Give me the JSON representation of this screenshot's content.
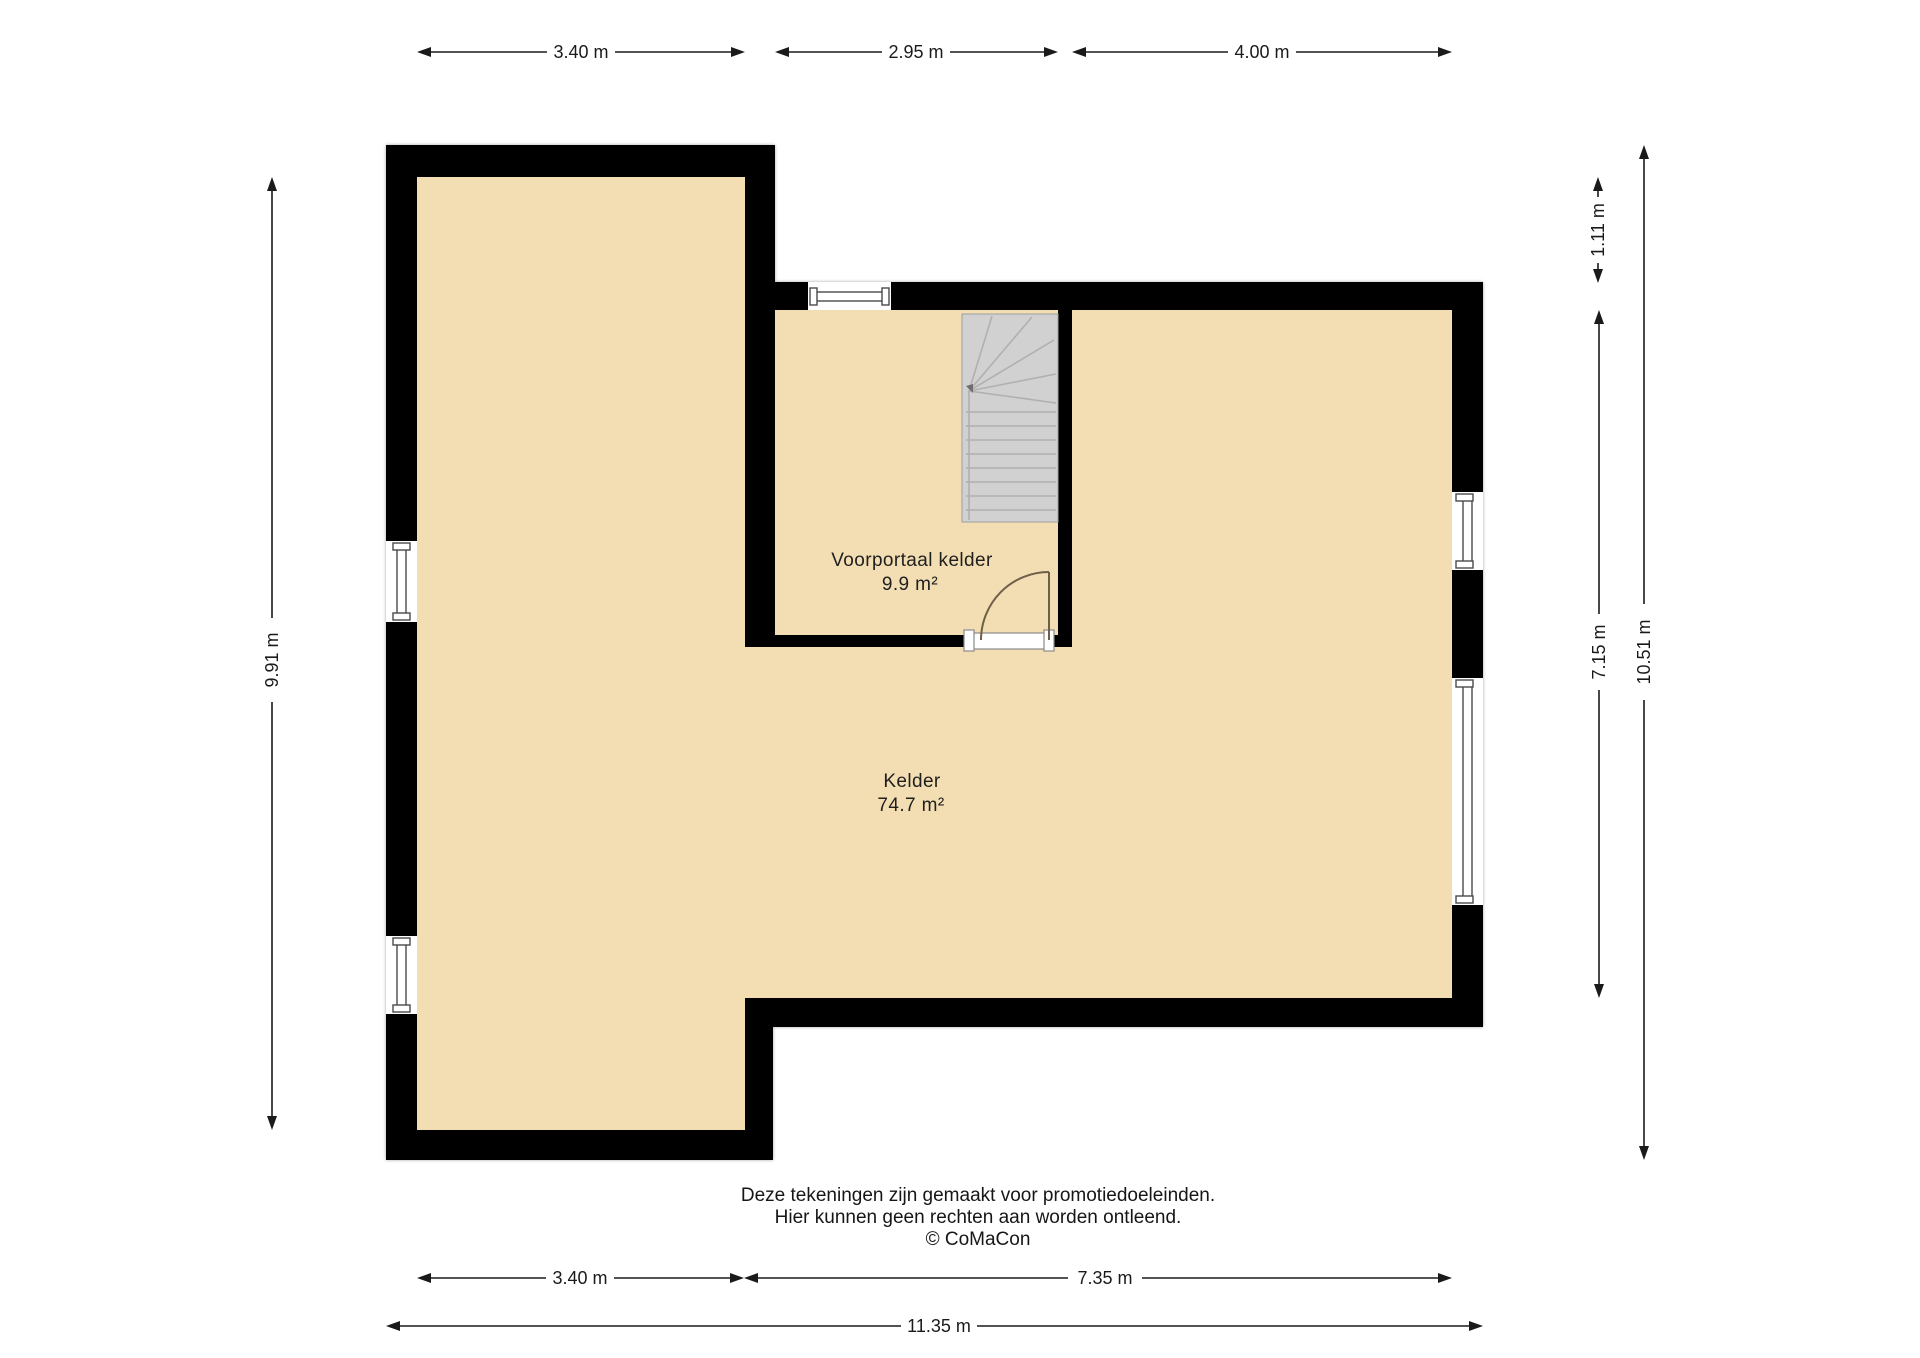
{
  "page": {
    "background": "#ffffff"
  },
  "colors": {
    "floor": "#f3ddb2",
    "wall": "#000000",
    "stairs_fill": "#d1d1d1",
    "stairs_line": "#b0b0b0",
    "door_arc": "#6e5f49",
    "dimension_ink": "#1a1a1a",
    "window_frame": "#4a4a4a"
  },
  "rooms": [
    {
      "name": "Voorportaal kelder",
      "area": "9.9 m²"
    },
    {
      "name": "Kelder",
      "area": "74.7 m²"
    }
  ],
  "dimensions": {
    "top": [
      {
        "label": "3.40 m"
      },
      {
        "label": "2.95 m"
      },
      {
        "label": "4.00 m"
      }
    ],
    "left": [
      {
        "label": "9.91 m"
      }
    ],
    "right": [
      {
        "label": "1.11 m"
      },
      {
        "label": "7.15 m"
      },
      {
        "label": "10.51 m"
      }
    ],
    "bottom": [
      {
        "label": "3.40 m"
      },
      {
        "label": "7.35 m"
      },
      {
        "label": "11.35 m"
      }
    ]
  },
  "footer": {
    "line1": "Deze tekeningen zijn gemaakt voor promotiedoeleinden.",
    "line2": "Hier kunnen geen rechten aan worden ontleend.",
    "line3": "© CoMaCon"
  }
}
